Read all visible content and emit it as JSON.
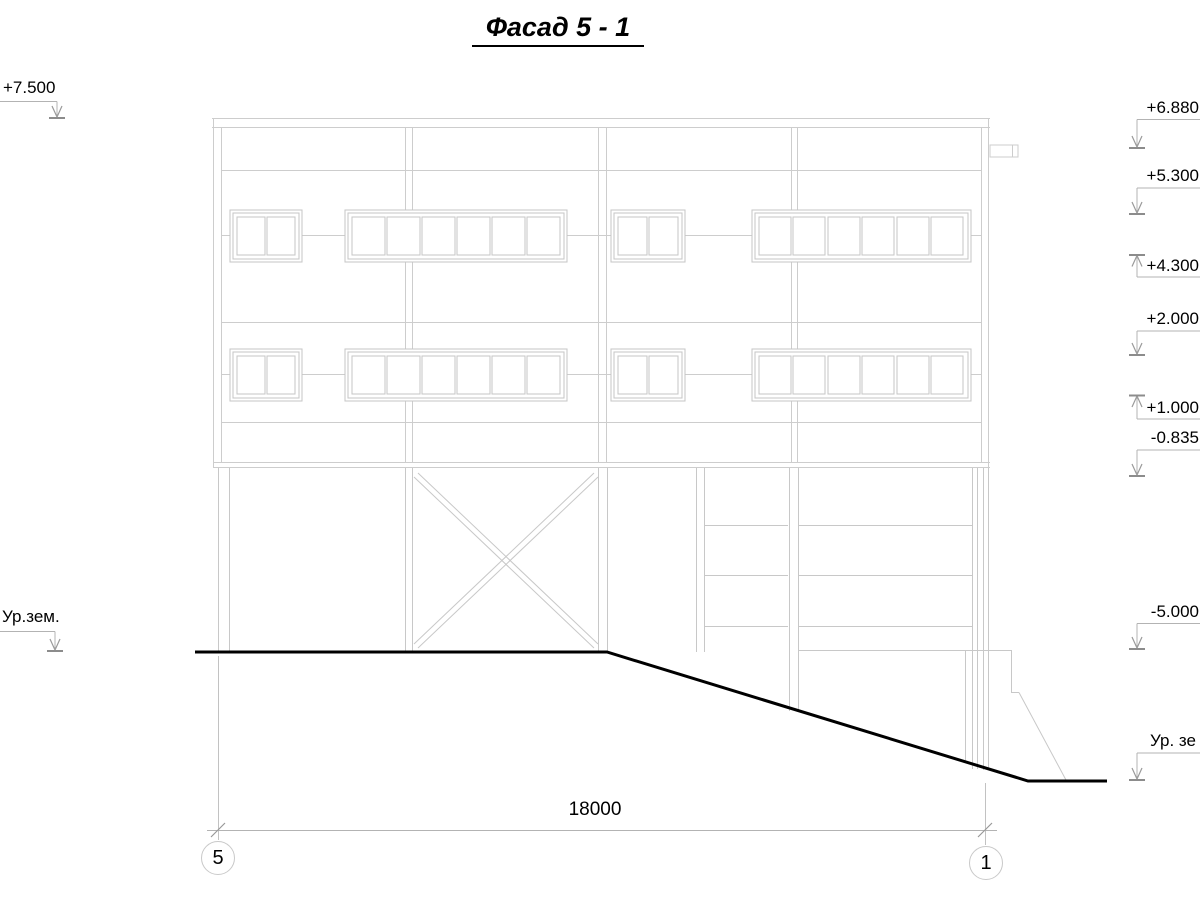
{
  "title": "Фасад 5 - 1",
  "elevation_marks_left": [
    {
      "label": "+7.500"
    },
    {
      "label": "Ур.зем."
    }
  ],
  "elevation_marks_right": [
    {
      "label": "+6.880"
    },
    {
      "label": "+5.300"
    },
    {
      "label": "+4.300"
    },
    {
      "label": "+2.000"
    },
    {
      "label": "+1.000"
    },
    {
      "label": "-0.835"
    },
    {
      "label": "-5.000"
    },
    {
      "label": "Ур. зе"
    }
  ],
  "dimension": {
    "length": "18000"
  },
  "axis_bubbles": [
    {
      "label": "5"
    },
    {
      "label": "1"
    }
  ]
}
